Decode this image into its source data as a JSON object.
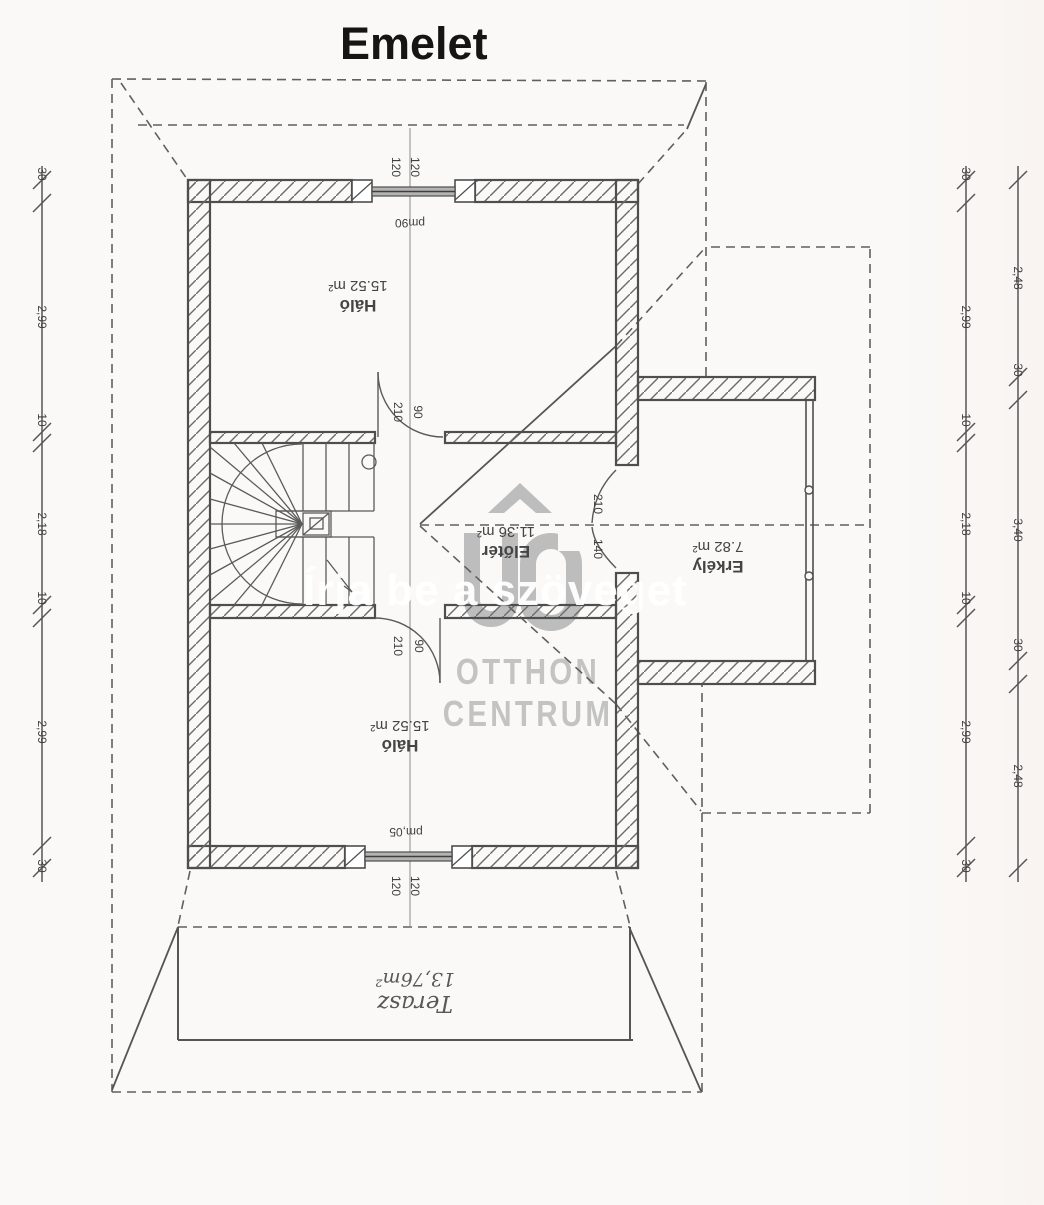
{
  "title": "Emelet",
  "rooms": {
    "bedroom_top": {
      "name": "Háló",
      "area": "15.52 m²"
    },
    "hall": {
      "name": "Előtér",
      "area": "11.36 m²"
    },
    "bedroom_bottom": {
      "name": "Háló",
      "area": "15.52 m²"
    },
    "balcony": {
      "name": "Erkély",
      "area": "7.82 m²"
    },
    "terrace": {
      "name": "Terasz",
      "area": "13,76m²"
    }
  },
  "dimension_chains": {
    "left": [
      "30",
      "2,99",
      "10",
      "2,18",
      "10",
      "2,99",
      "30"
    ],
    "right_inner": [
      "30",
      "2,99",
      "10",
      "2,18",
      "10",
      "2,99",
      "30"
    ],
    "right_outer": [
      "2,48",
      "30",
      "3,40",
      "30",
      "2,48"
    ]
  },
  "openings": {
    "top_window_widths": [
      "120",
      "120"
    ],
    "top_window_parapet": "pm90",
    "door_top": {
      "height": "210",
      "width": "90"
    },
    "balcony_door": {
      "height": "210",
      "width": "140"
    },
    "door_bottom": {
      "height": "210",
      "width": "90"
    },
    "bottom_window_widths": [
      "120",
      "120"
    ],
    "bottom_window_parapet": "pm,05"
  },
  "watermark": {
    "overlay_text": "Írja be a szöveget",
    "logo_monogram": "OC",
    "brand_top": "OTTHON",
    "brand_bottom": "CENTRUM"
  }
}
